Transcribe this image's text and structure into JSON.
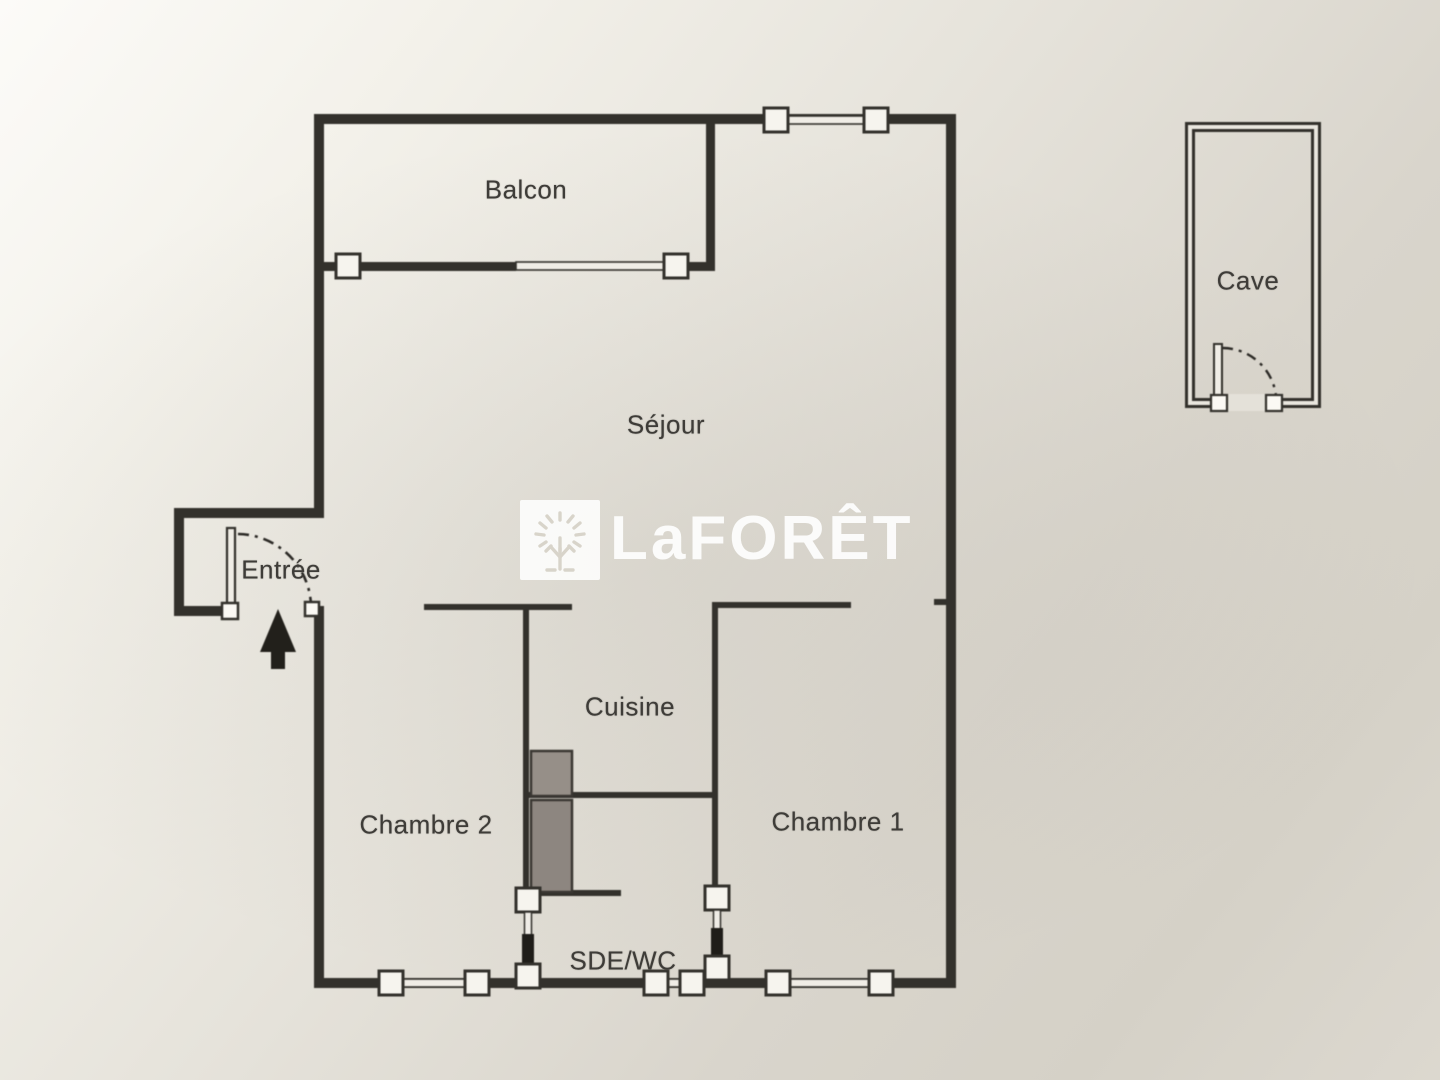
{
  "brand": {
    "wordmark": "LaFORÊT",
    "icon": "tree-icon"
  },
  "plan": {
    "rooms": [
      {
        "key": "balcon",
        "label": "Balcon"
      },
      {
        "key": "sejour",
        "label": "Séjour"
      },
      {
        "key": "entree",
        "label": "Entrée"
      },
      {
        "key": "cuisine",
        "label": "Cuisine"
      },
      {
        "key": "chambre2",
        "label": "Chambre 2"
      },
      {
        "key": "chambre1",
        "label": "Chambre 1"
      },
      {
        "key": "sde_wc",
        "label": "SDE/WC"
      },
      {
        "key": "cave",
        "label": "Cave"
      }
    ],
    "colors": {
      "paper_light": "#fcfbf8",
      "paper_dark": "#d5d1c7",
      "wall": "#33312c",
      "window_fill": "#f6f4ee",
      "fixture_gray_upper": "#968f88",
      "fixture_gray_lower": "#8d8680",
      "label_text": "#3e3c38",
      "watermark": "#ffffff"
    }
  }
}
